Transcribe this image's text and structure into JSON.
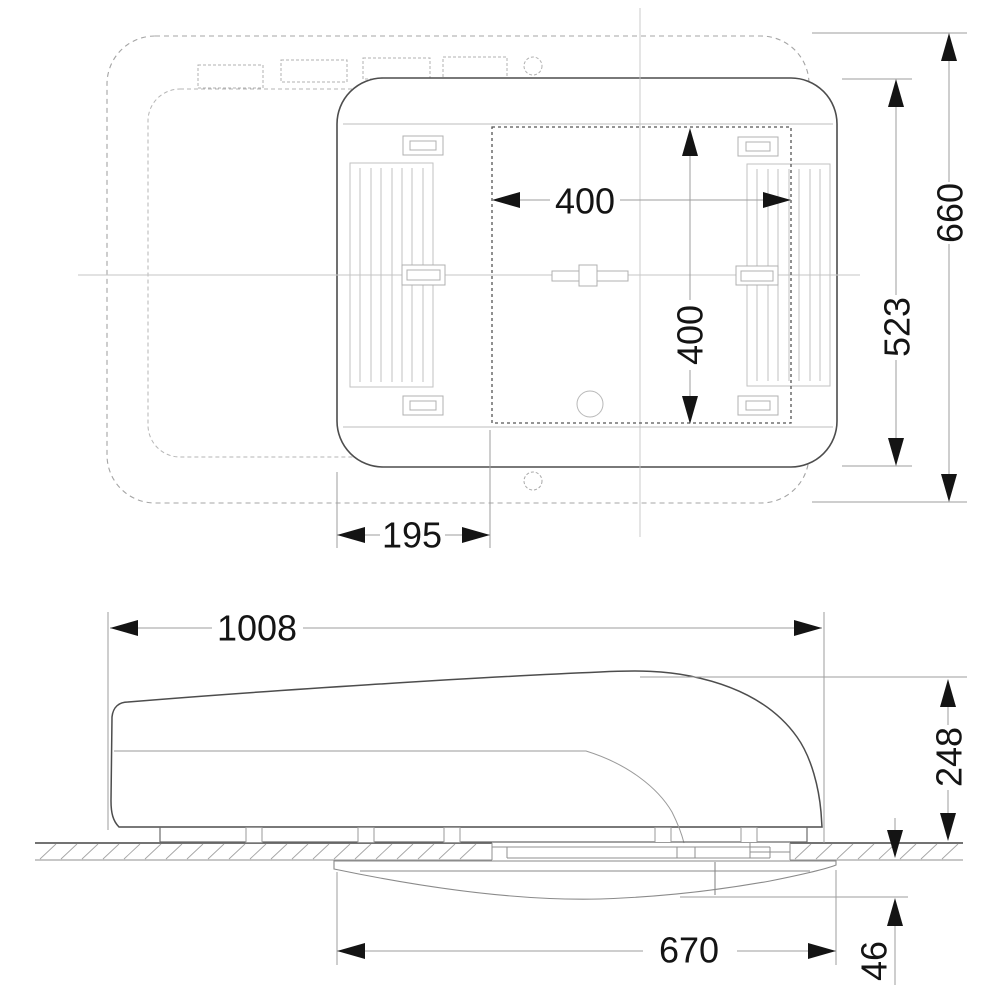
{
  "drawing": {
    "views": {
      "top": {
        "dimensions": {
          "cutout_width": "400",
          "cutout_depth": "400",
          "overall_depth": "660",
          "unit_depth": "523",
          "side_offset": "195"
        }
      },
      "side": {
        "dimensions": {
          "overall_length": "1008",
          "height_above_roof": "248",
          "interior_unit_length": "670",
          "interior_drop": "46"
        }
      }
    },
    "colors": {
      "ink": "#141414",
      "outline": "#4d4d4d",
      "light_line": "#b0b0b0",
      "dim_line": "#9e9e9e"
    }
  }
}
